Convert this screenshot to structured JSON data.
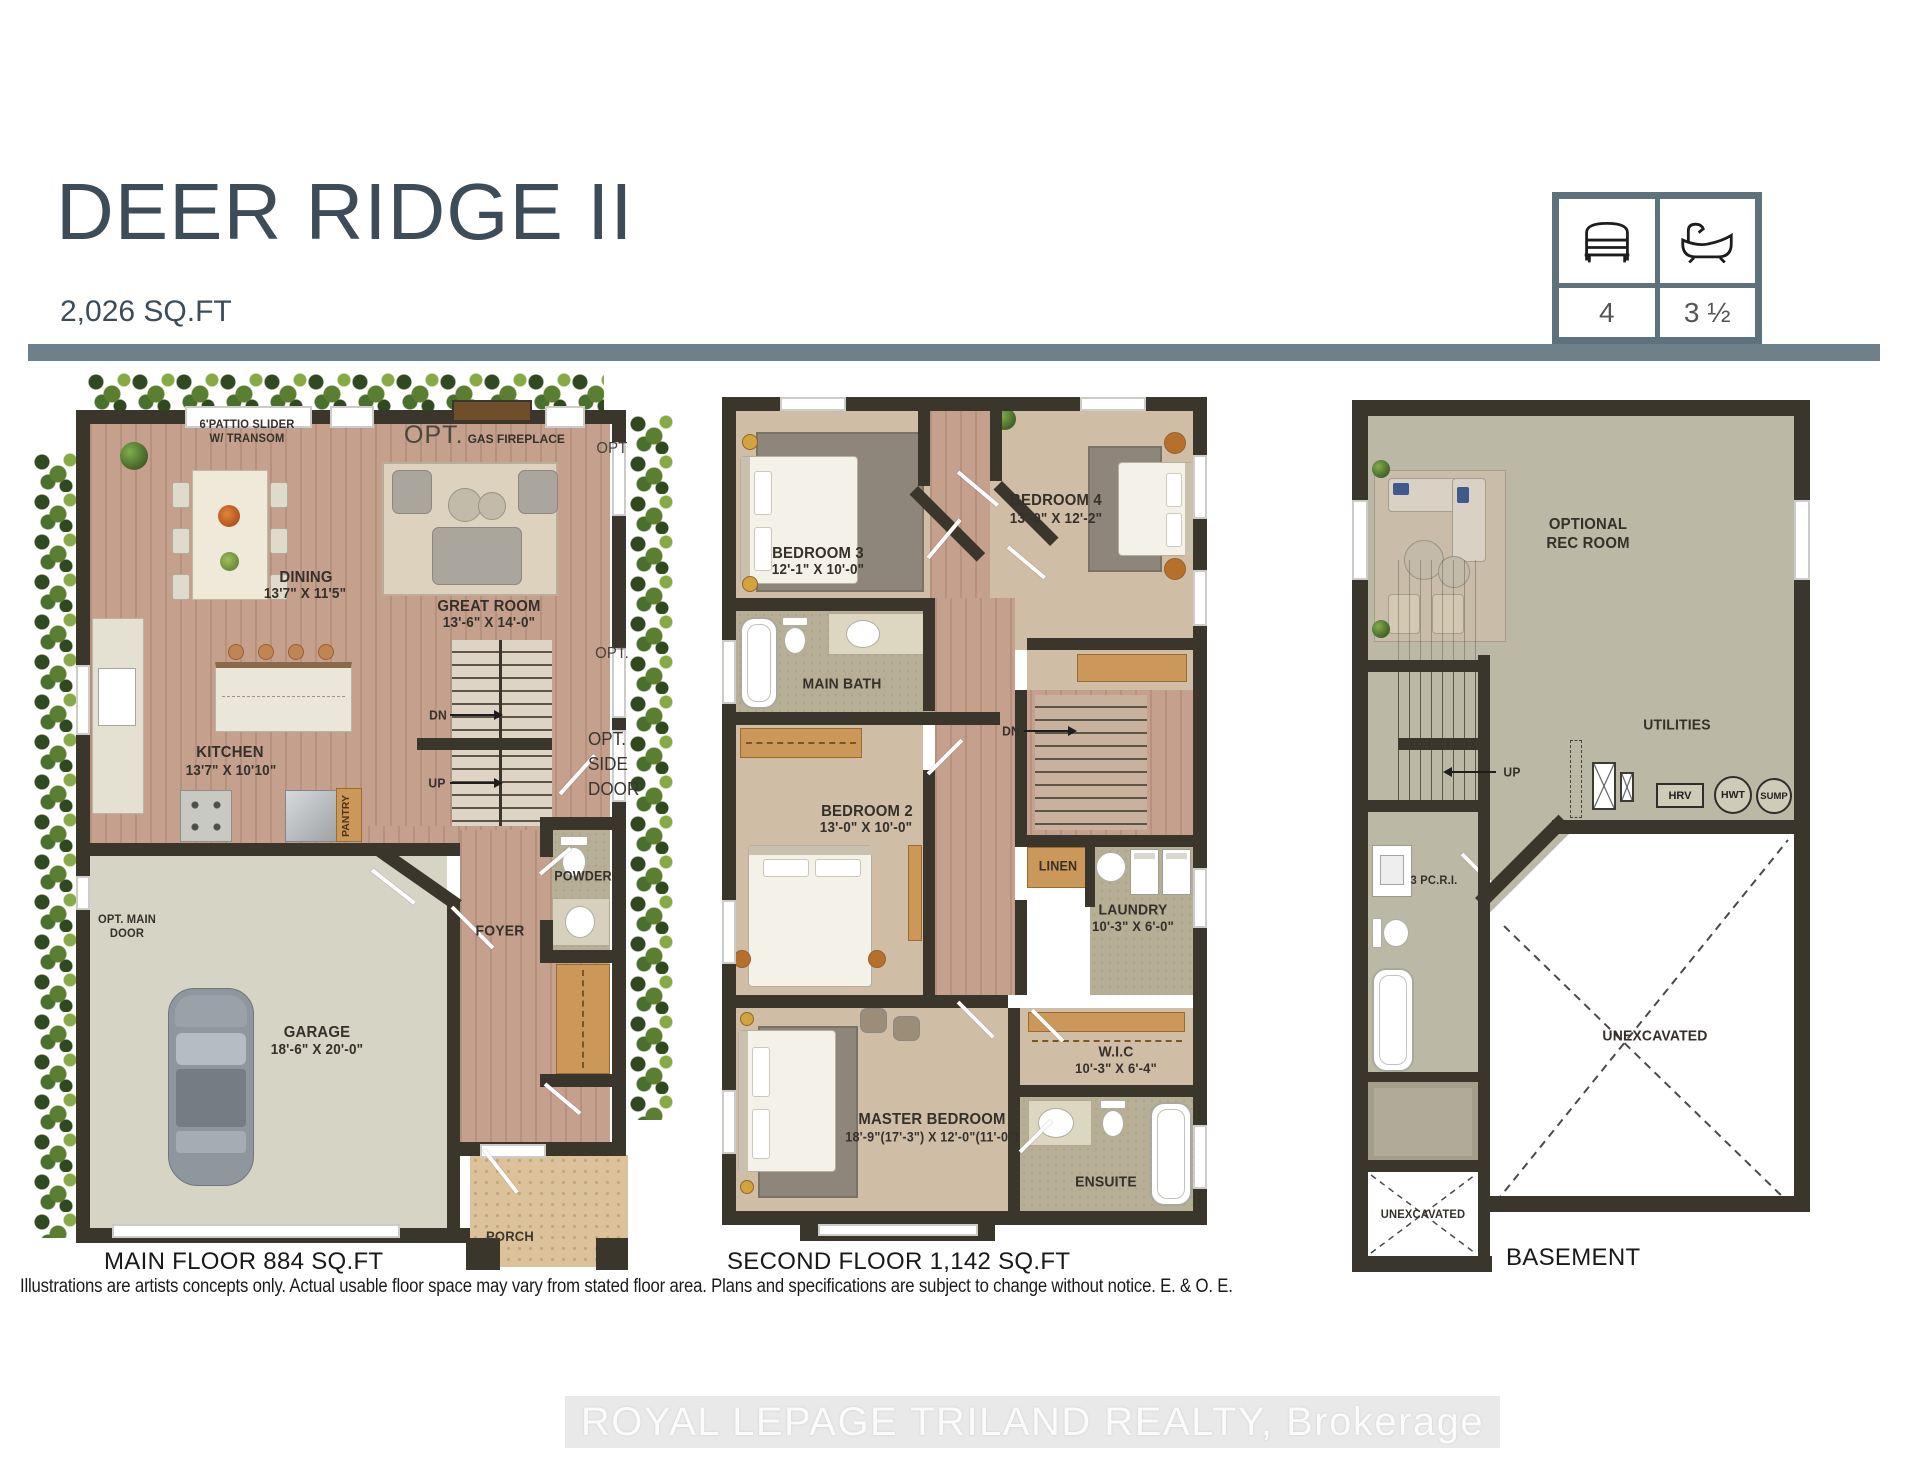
{
  "colors": {
    "accent_bar": "#6e818b",
    "title_text": "#3c4c59",
    "wall": "#3a362b",
    "stats_border": "#5e727d"
  },
  "header": {
    "title": "DEER RIDGE II",
    "subtitle": "2,026 SQ.FT"
  },
  "stats": {
    "beds": "4",
    "baths": "3 ½"
  },
  "main_floor": {
    "caption": "MAIN FLOOR 884 SQ.FT",
    "patio_line1": "6'PATTIO SLIDER",
    "patio_line2": "W/ TRANSOM",
    "opt_prefix": "OPT.",
    "fireplace": "GAS FIREPLACE",
    "dining": {
      "name": "DINING",
      "dims": "13'7\" X 11'5\""
    },
    "great_room": {
      "name": "GREAT ROOM",
      "dims": "13'-6\" X 14'-0\""
    },
    "kitchen": {
      "name": "KITCHEN",
      "dims": "13'7\" X 10'10\""
    },
    "pantry": "PANTRY",
    "stairs": {
      "dn": "DN",
      "up": "UP"
    },
    "opt_window1": "OPT",
    "opt_window2": "OPT.",
    "side_door_line1": "OPT.",
    "side_door_line2": "SIDE",
    "side_door_line3": "DOOR",
    "powder": "POWDER",
    "foyer": "FOYER",
    "main_door_line1": "OPT. MAIN",
    "main_door_line2": "DOOR",
    "garage": {
      "name": "GARAGE",
      "dims": "18'-6\" X 20'-0\""
    },
    "porch": "PORCH"
  },
  "second_floor": {
    "caption": "SECOND FLOOR 1,142 SQ.FT",
    "bedroom3": {
      "name": "BEDROOM 3",
      "dims": "12'-1\" X 10'-0\""
    },
    "bedroom4": {
      "name": "BEDROOM 4",
      "dims": "13'-0\" X 12'-2\""
    },
    "main_bath": "MAIN BATH",
    "dn": "DN",
    "bedroom2": {
      "name": "BEDROOM 2",
      "dims": "13'-0\" X 10'-0\""
    },
    "linen": "LINEN",
    "laundry": {
      "name": "LAUNDRY",
      "dims": "10'-3\" X 6'-0\""
    },
    "wic": {
      "name": "W.I.C",
      "dims": "10'-3\" X 6'-4\""
    },
    "master": {
      "name": "MASTER BEDROOM",
      "dims": "18'-9\"(17'-3\") X 12'-0\"(11'-0\")"
    },
    "ensuite": "ENSUITE"
  },
  "basement": {
    "caption": "BASEMENT",
    "rec_line1": "OPTIONAL",
    "rec_line2": "REC ROOM",
    "up": "UP",
    "utilities": "UTILITIES",
    "hrv": "HRV",
    "hwt": "HWT",
    "sump": "SUMP",
    "rough_in": "3 PC.R.I.",
    "unexcavated_main": "UNEXCAVATED",
    "unexcavated_small": "UNEXCAVATED"
  },
  "footer": {
    "disclaimer": "Illustrations are artists concepts only. Actual usable floor space may vary from stated floor area. Plans and specifications are subject to change without notice. E. & O. E.",
    "watermark": "ROYAL LEPAGE TRILAND REALTY, Brokerage"
  }
}
